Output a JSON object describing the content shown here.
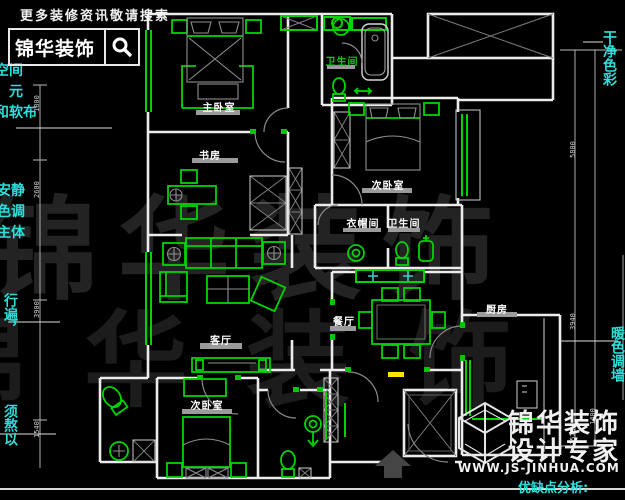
{
  "header": {
    "hint": "更多装修资讯敬请搜索",
    "brand": "锦华装饰"
  },
  "annotations": {
    "left": [
      "空间",
      "，元",
      "和软布",
      "安静",
      "色调",
      "主体",
      "行遍，",
      "须熬以"
    ],
    "right": [
      "干净色彩",
      "暖色调墙"
    ]
  },
  "rooms": {
    "master": "主卧室",
    "study": "书房",
    "bedroom_right": "次卧室",
    "bedroom_bottom": "次卧室",
    "bath_top": "卫生间",
    "bath_master": "卫生间",
    "cloak": "衣帽间",
    "living": "客厅",
    "dining": "餐厅",
    "kitchen": "厨房"
  },
  "dims": {
    "left": [
      "1800",
      "2600",
      "3900",
      "1540"
    ],
    "right": [
      "5800",
      "3940",
      "1400",
      "1520"
    ]
  },
  "branding": {
    "title1": "锦华装饰",
    "title2": "设计专家",
    "url": "WWW.JS-JINHUA.COM",
    "analysis": "优缺点分析:"
  },
  "watermark": {
    "row1": "锦华装饰",
    "row2": "锦华装饰"
  },
  "colors": {
    "green": "#00d400",
    "cyan": "#2be0dc",
    "wall": "#ececec",
    "furniture_gray": "#8f8f8f",
    "yellow": "#ffe400"
  }
}
